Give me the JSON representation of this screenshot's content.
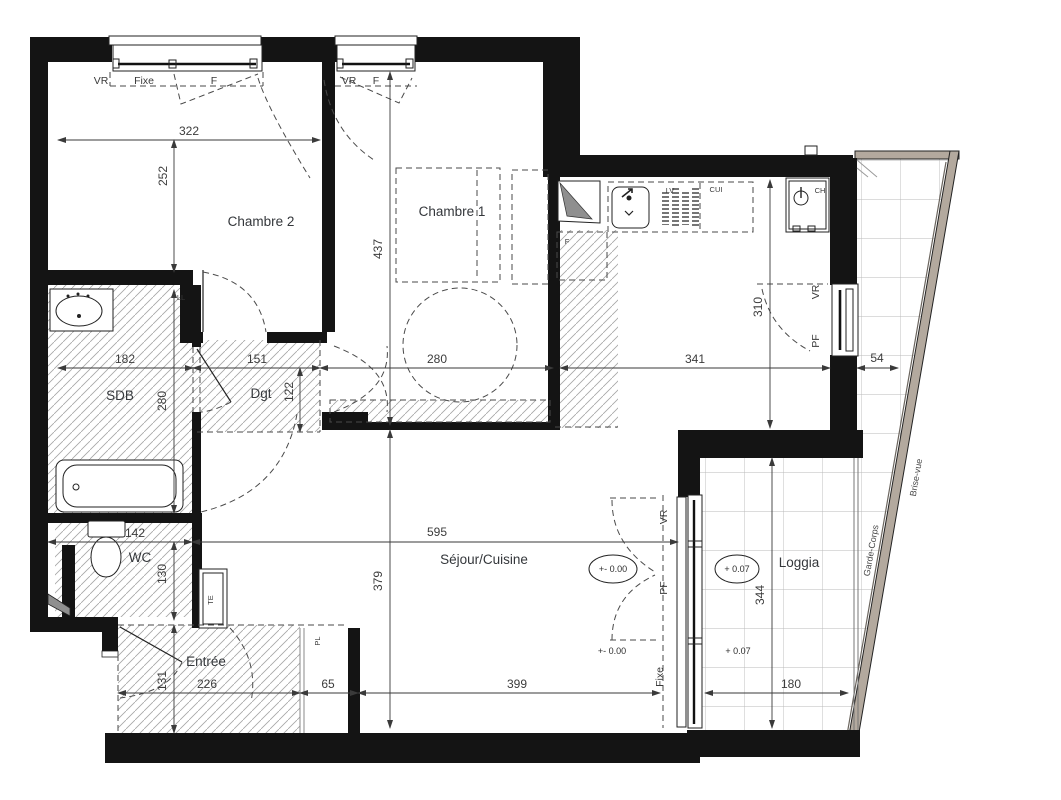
{
  "rooms": {
    "chambre2": "Chambre 2",
    "chambre1": "Chambre 1",
    "sdb": "SDB",
    "dgt": "Dgt",
    "wc": "WC",
    "entree": "Entrée",
    "sejour": "Séjour/Cuisine",
    "loggia": "Loggia"
  },
  "dims": {
    "d322": "322",
    "d252": "252",
    "d437": "437",
    "d280": "280",
    "d182": "182",
    "d151": "151",
    "d341": "341",
    "d54": "54",
    "d122": "122",
    "d142": "142",
    "d130": "130",
    "d595": "595",
    "d379": "379",
    "d131": "131",
    "d226": "226",
    "d65": "65",
    "d399": "399",
    "d180": "180",
    "d344": "344",
    "d310": "310"
  },
  "labels": {
    "vr": "VR",
    "fixe": "Fixe",
    "f": "F",
    "pf": "PF",
    "ll": "LL",
    "te": "TE",
    "pl": "PL",
    "lv": "LV",
    "cui": "CUI",
    "ch": "CH",
    "fridge": "F",
    "garde_corps": "Garde-Corps",
    "brise_vue": "Brise-vue"
  },
  "levels": {
    "zero": "+- 0.00",
    "plus07": "+ 0.07"
  }
}
